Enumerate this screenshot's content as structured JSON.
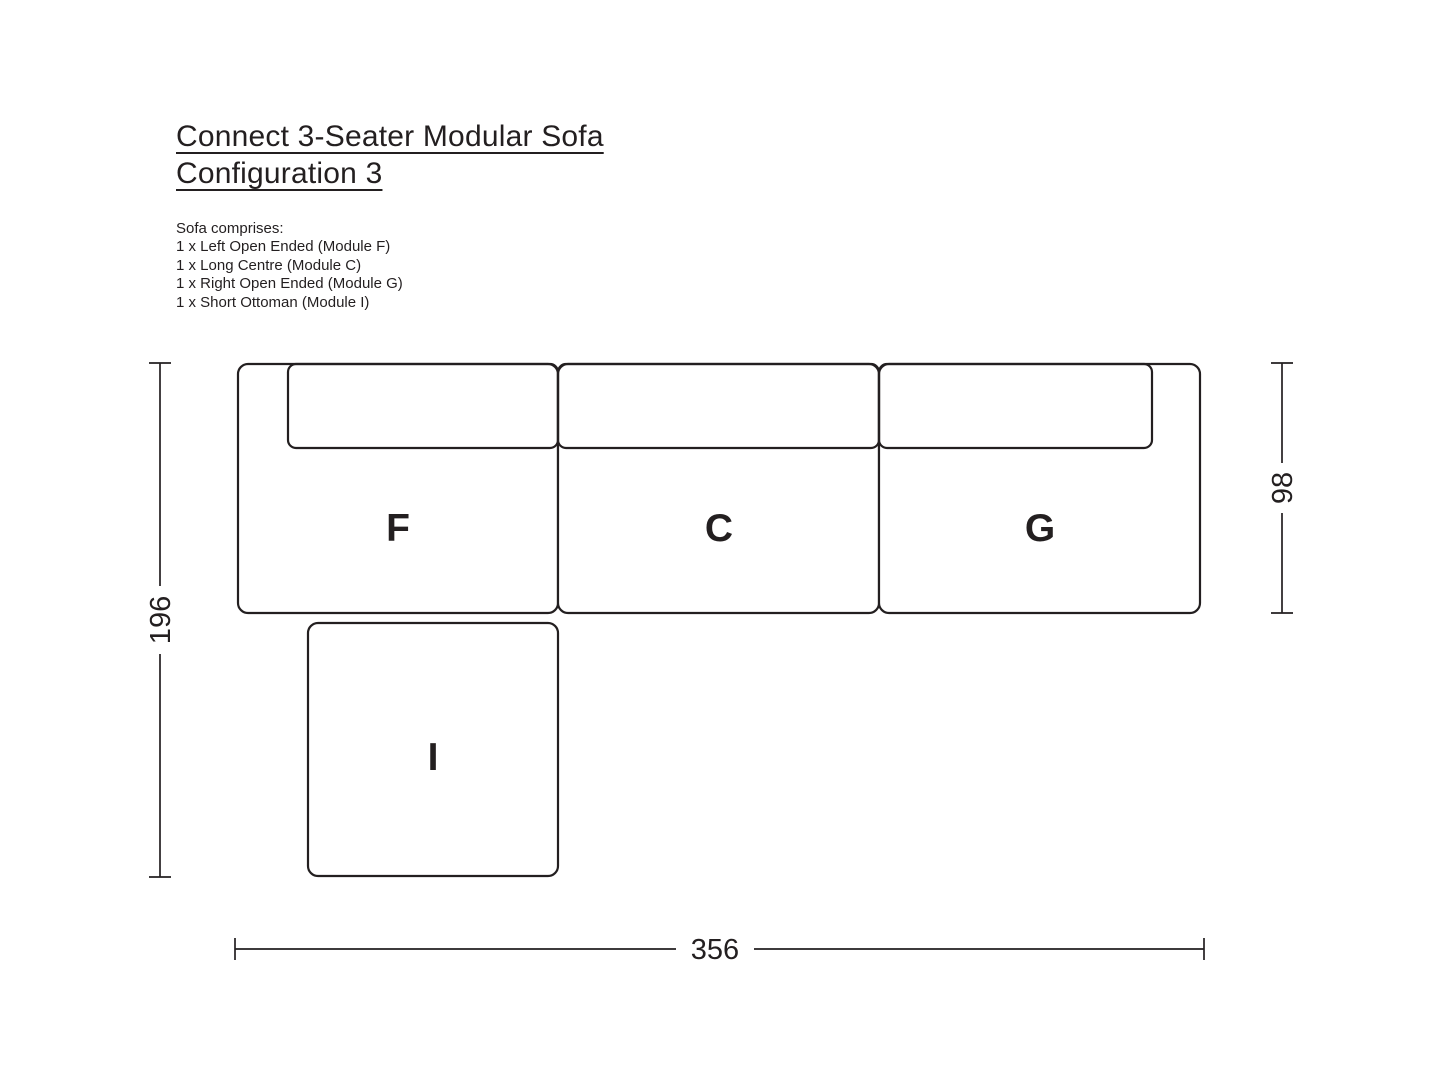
{
  "page": {
    "title_line1": "Connect 3-Seater Modular Sofa",
    "title_line2": "Configuration 3"
  },
  "composition": {
    "heading": "Sofa comprises:",
    "items": [
      "1 x Left Open Ended (Module F)",
      "1 x Long Centre (Module C)",
      "1 x Right Open Ended (Module G)",
      "1 x Short Ottoman (Module I)"
    ]
  },
  "diagram": {
    "modules": [
      {
        "label": "F"
      },
      {
        "label": "C"
      },
      {
        "label": "G"
      },
      {
        "label": "I"
      }
    ],
    "dimensions": {
      "overall_depth": "196",
      "sofa_depth": "98",
      "overall_width": "356"
    }
  },
  "colors": {
    "ink": "#231f20",
    "background": "#ffffff"
  }
}
